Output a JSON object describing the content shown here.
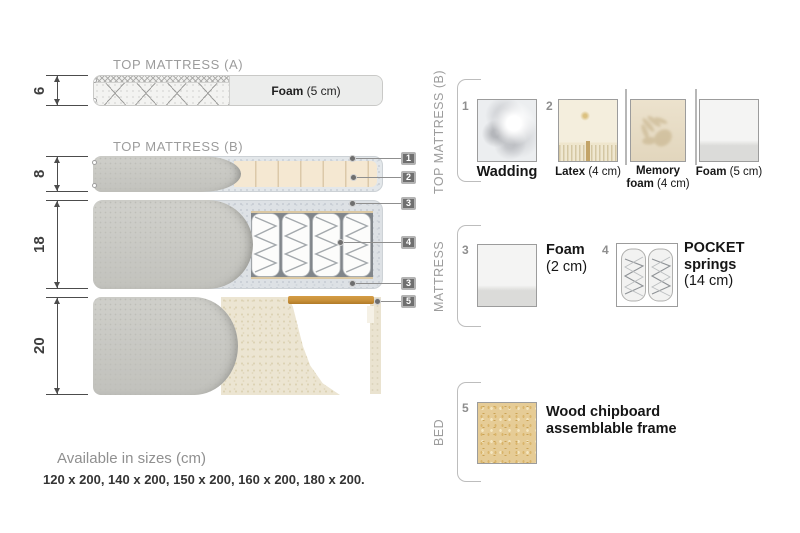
{
  "titles": {
    "top_a": "TOP MATTRESS (A)",
    "top_b": "TOP MATTRESS (B)"
  },
  "dims": {
    "a": "6",
    "b": "8",
    "m": "18",
    "bed": "20"
  },
  "foam_a": {
    "bold": "Foam",
    "rest": " (5 cm)"
  },
  "callouts": {
    "c1": "1",
    "c2": "2",
    "c3": "3",
    "c4": "4",
    "c3b": "3",
    "c5": "5"
  },
  "sections": {
    "top_b": {
      "label": "TOP MATTRESS (B)",
      "wadding": {
        "num": "1",
        "bold": "Wadding"
      },
      "latex": {
        "num": "2",
        "bold": "Latex",
        "rest": " (4 cm)"
      },
      "memory": {
        "l1": "Memory",
        "l2b": "foam",
        "l2r": " (4 cm)"
      },
      "foam": {
        "bold": "Foam",
        "rest": " (5 cm)"
      }
    },
    "mattress": {
      "label": "MATTRESS",
      "foam": {
        "num": "3",
        "l1": "Foam",
        "l2": "(2 cm)"
      },
      "pocket": {
        "num": "4",
        "l1": "POCKET",
        "l2": "springs",
        "l3": "(14 cm)"
      }
    },
    "bed": {
      "label": "BED",
      "chip": {
        "num": "5",
        "l1": "Wood chipboard",
        "l2": "assemblable frame"
      }
    }
  },
  "footer": {
    "title": "Available in sizes (cm)",
    "sizes": "120 x 200, 140 x 200, 150 x 200, 160 x 200, 180 x 200."
  },
  "colors": {
    "wood": "#c9913a",
    "cover_gray": "#c9c9c4",
    "latex_beige": "#f5e8d2",
    "wadding_gray": "#e3e7ea",
    "foam_surround": "#dde1e5",
    "chipboard_tan": "#e6cc96",
    "callout_box": "#6f6f6f",
    "text_gray": "#9c9c9c"
  }
}
